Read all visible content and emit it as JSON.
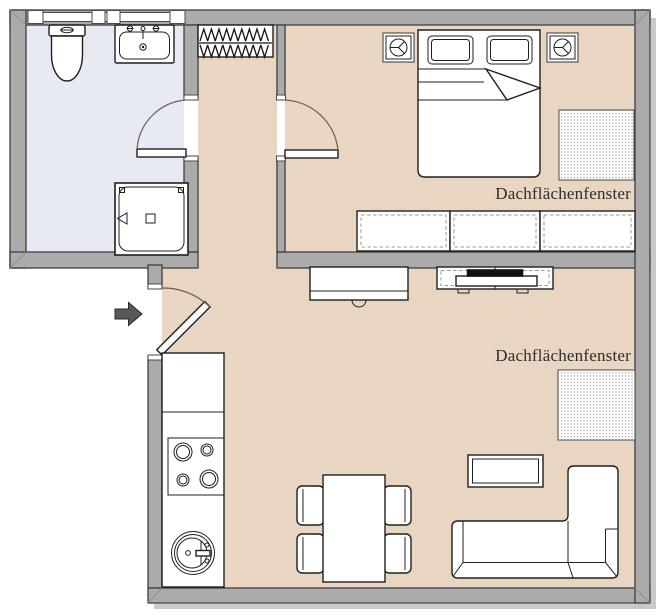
{
  "plan": {
    "labels": {
      "roof_window_bedroom": "Dachflächenfenster",
      "roof_window_living": "Dachflächenfenster"
    }
  },
  "colors": {
    "outside": "#ffffff",
    "wall_fill": "#ababab",
    "wall_line": "#3f3f3f",
    "floor_main": "#e8d6c2",
    "floor_bath": "#e7eaf2",
    "furniture_fill": "#ffffff",
    "furniture_line": "#1f1f1f",
    "detail_dash": "#9a9a9a",
    "door_arc": "#6d5c50",
    "window_dot": "#777777",
    "entry_arrow": "#585858",
    "label_text": "#2e2e2e"
  },
  "symbols": [
    "toilet",
    "washbasin",
    "shower",
    "window",
    "wardrobe-hangers",
    "door-swing",
    "entry-arrow",
    "double-bed",
    "pillow",
    "ceiling-spot-lamp",
    "roof-window-dotted",
    "wardrobe-unit",
    "sideboard",
    "tv-lowboard",
    "tv",
    "kitchen-counter",
    "cooktop-burners",
    "kitchen-round-sink",
    "dining-table",
    "chair",
    "coffee-table",
    "corner-sofa"
  ]
}
